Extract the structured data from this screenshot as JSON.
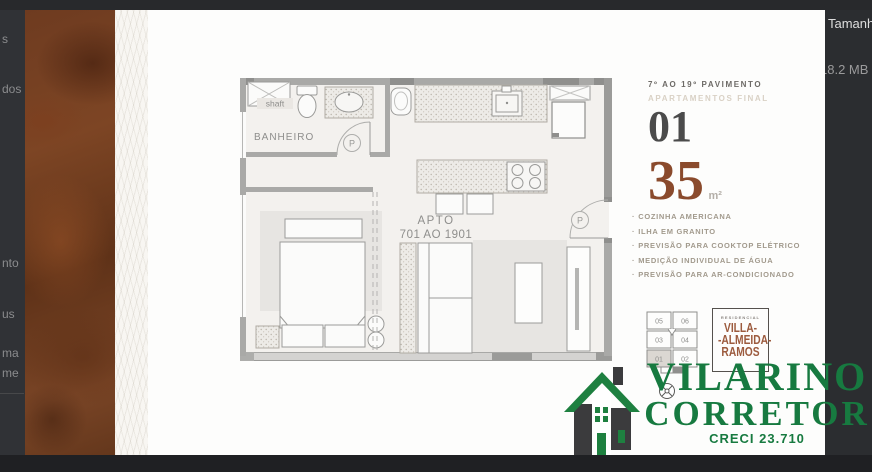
{
  "background": {
    "left_fragments": [
      "s",
      "dos",
      "nto",
      "us",
      "ma",
      "me"
    ],
    "file_info": {
      "label": "Tamanh",
      "value": "18.2 MB"
    }
  },
  "flyer": {
    "header": {
      "floors": "7º AO 19º PAVIMENTO",
      "subtitle": "APARTAMENTOS FINAL",
      "unit": "01",
      "area": "35",
      "area_unit": "m²"
    },
    "features_bullet": "·",
    "features": [
      "COZINHA AMERICANA",
      "ILHA EM GRANITO",
      "PREVISÃO PARA COOKTOP ELÉTRICO",
      "MEDIÇÃO INDIVIDUAL DE ÁGUA",
      "PREVISÃO PARA AR-CONDICIONADO"
    ],
    "floor_plan": {
      "shaft": "shaft",
      "bathroom": "BANHEIRO",
      "apto_line1": "APTO",
      "apto_line2": "701 AO 1901",
      "door_marker": "P"
    },
    "key_plan": {
      "units": [
        "05",
        "06",
        "03",
        "04",
        "01",
        "02"
      ],
      "highlighted": "01"
    },
    "residencial": {
      "tagline": "RESIDENCIAL",
      "lines": [
        "VILLA-",
        "-ALMEIDA-",
        "RAMOS"
      ]
    }
  },
  "broker": {
    "name": "VILARINO",
    "role": "CORRETOR",
    "license": "CRECI 23.710"
  },
  "colors": {
    "accent_brown": "#8a4a2c",
    "logo_green": "#177a40",
    "villa_brown": "#9c5b3e",
    "wall_gray": "#a9a9a7"
  }
}
